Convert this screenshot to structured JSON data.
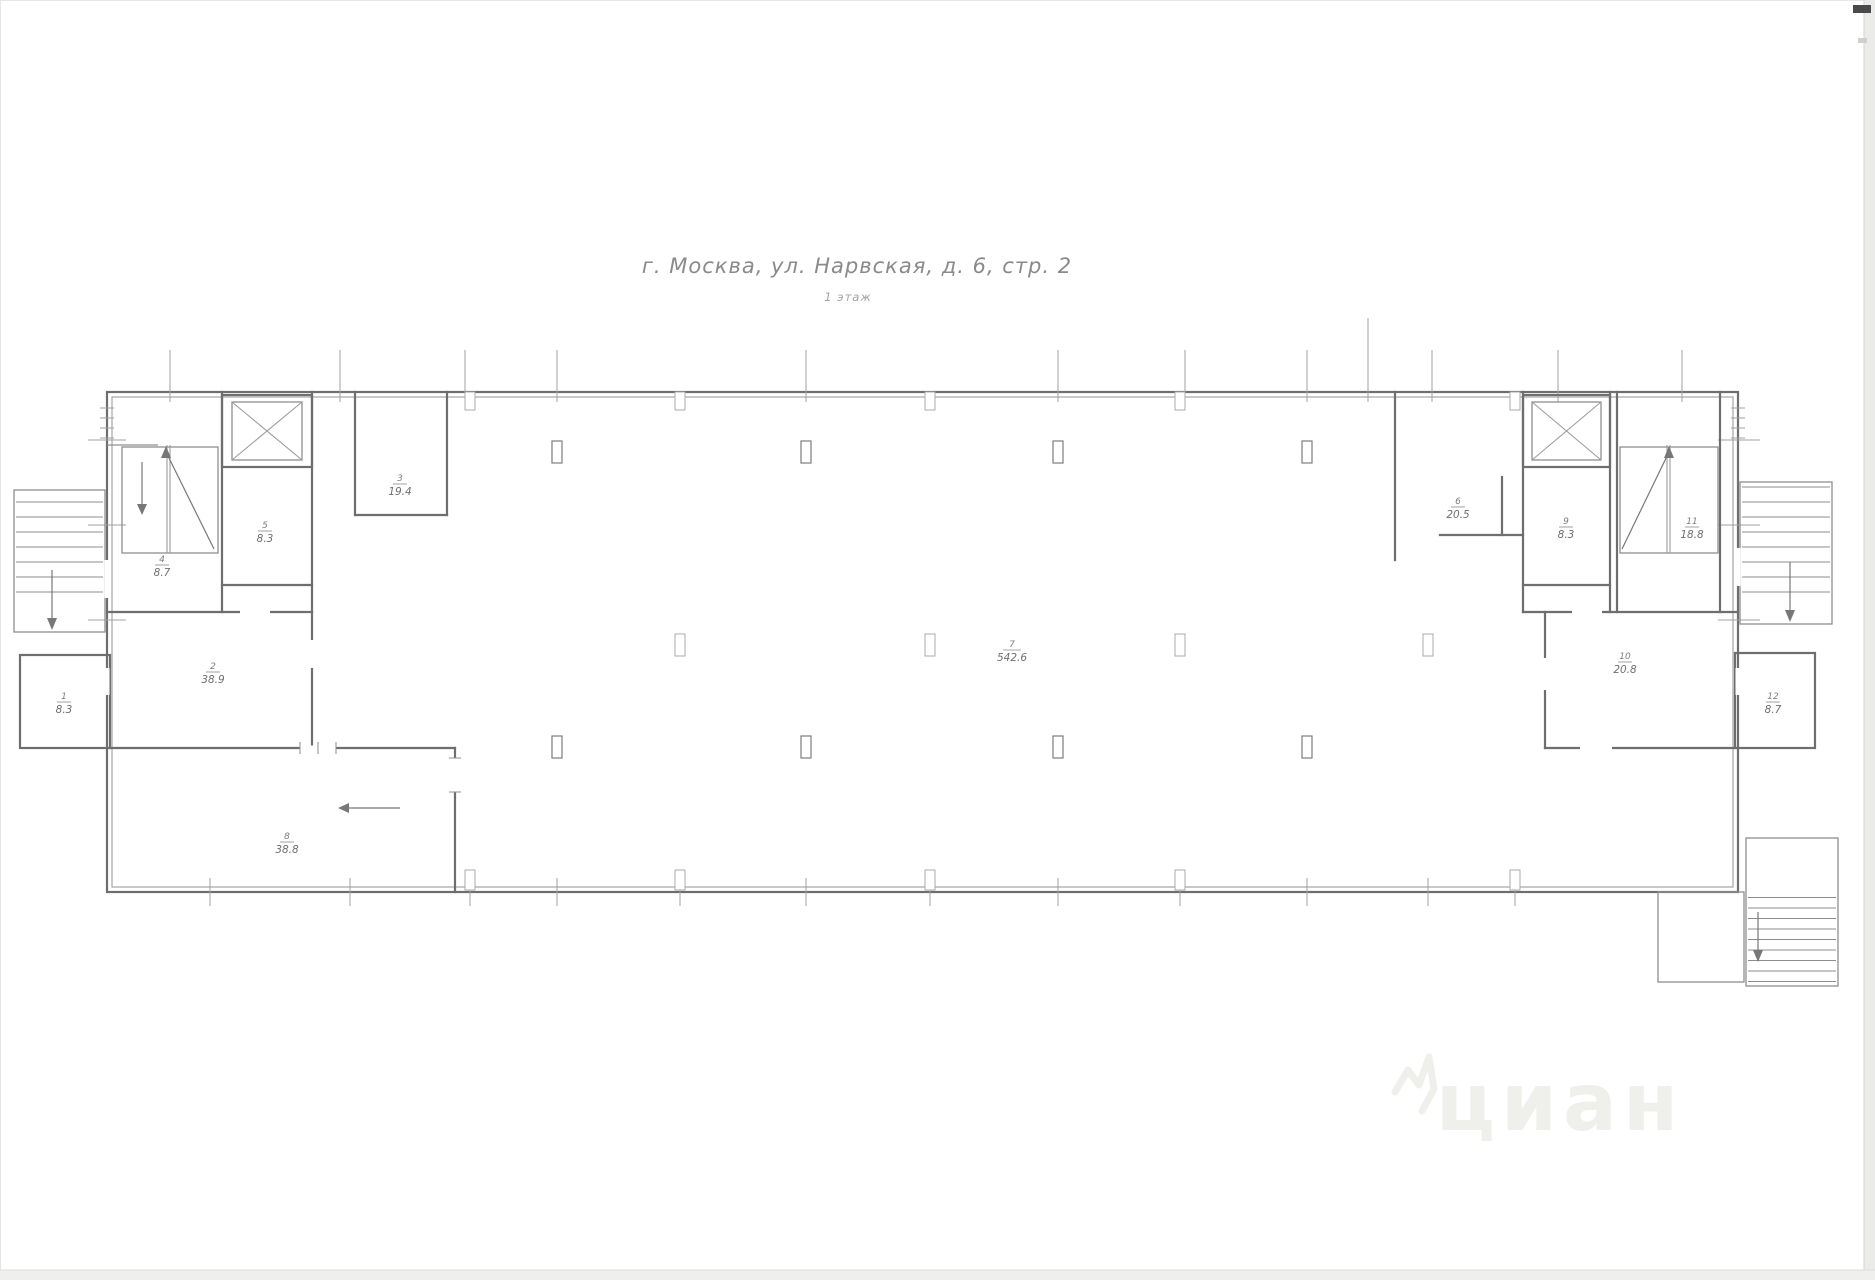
{
  "title": "г. Москва, ул. Нарвская, д. 6, стр. 2",
  "subtitle": "1 этаж",
  "watermark": "циан",
  "rooms": [
    {
      "num": "1",
      "area": "8.3"
    },
    {
      "num": "4",
      "area": "8.7"
    },
    {
      "num": "5",
      "area": "8.3"
    },
    {
      "num": "3",
      "area": "19.4"
    },
    {
      "num": "2",
      "area": "38.9"
    },
    {
      "num": "8",
      "area": "38.8"
    },
    {
      "num": "7",
      "area": "542.6"
    },
    {
      "num": "6",
      "area": "20.5"
    },
    {
      "num": "9",
      "area": "8.3"
    },
    {
      "num": "11",
      "area": "18.8"
    },
    {
      "num": "10",
      "area": "20.8"
    },
    {
      "num": "12",
      "area": "8.7"
    }
  ]
}
